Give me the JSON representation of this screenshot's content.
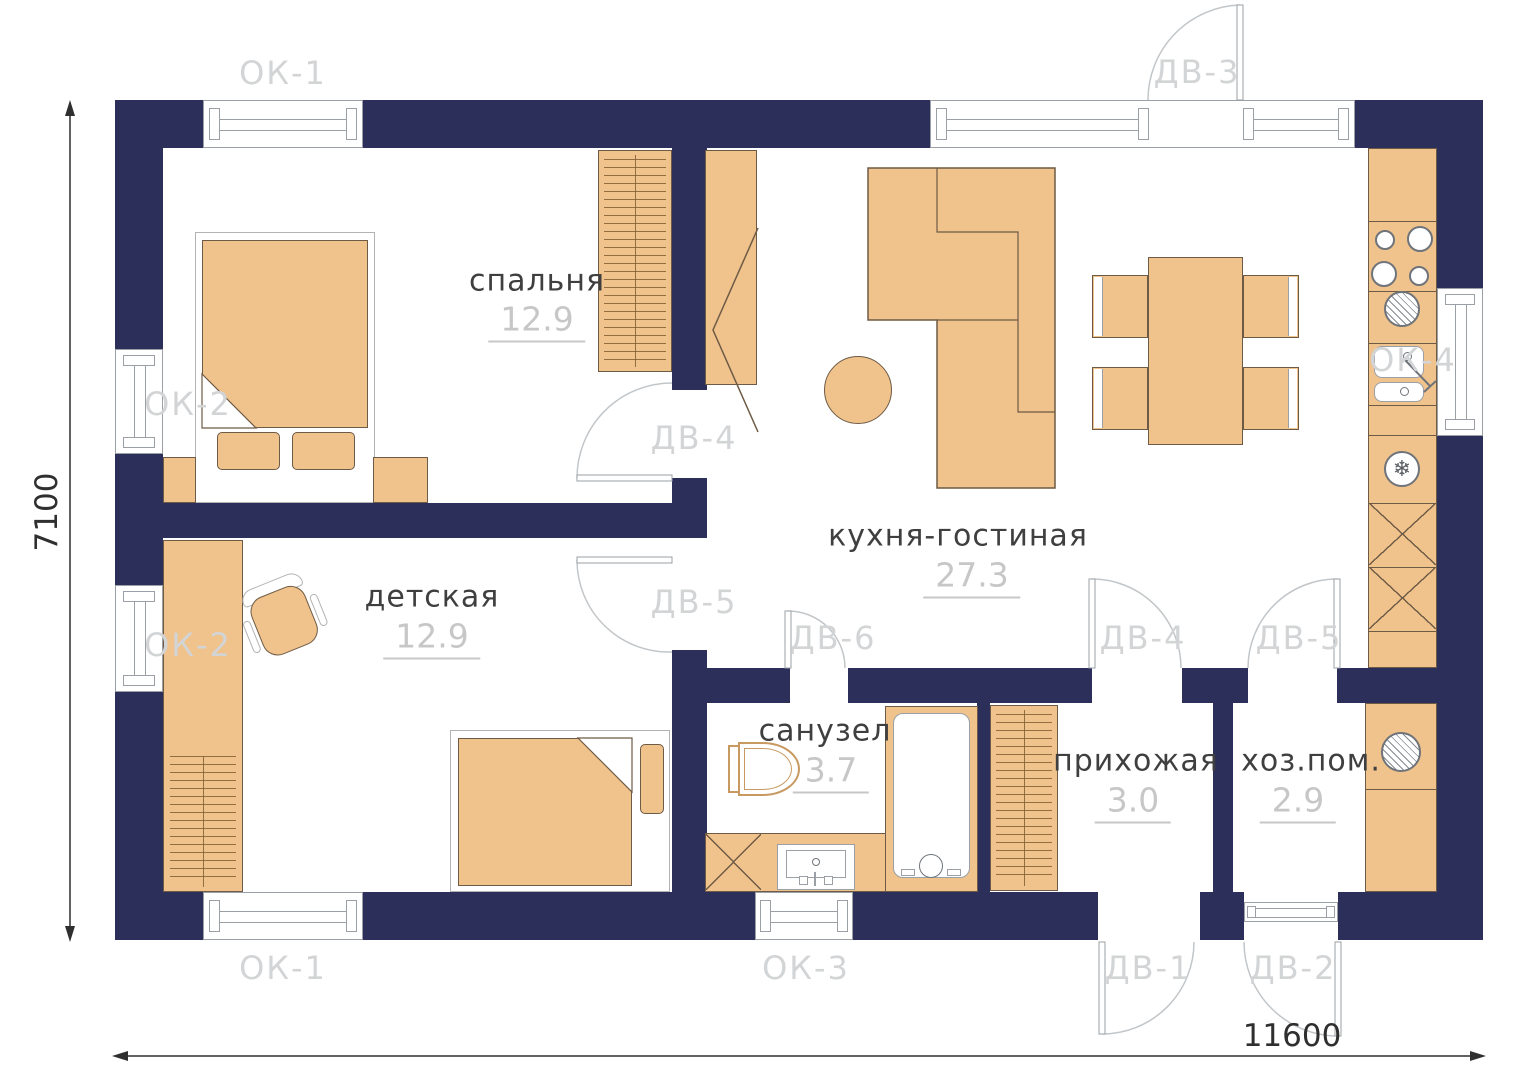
{
  "plan": {
    "rooms": [
      {
        "key": "bedroom",
        "name": "спальня",
        "area": "12.9"
      },
      {
        "key": "nursery",
        "name": "детская",
        "area": "12.9"
      },
      {
        "key": "kitchen_living",
        "name": "кухня-гостиная",
        "area": "27.3"
      },
      {
        "key": "bathroom",
        "name": "санузел",
        "area": "3.7"
      },
      {
        "key": "hallway",
        "name": "прихожая",
        "area": "3.0"
      },
      {
        "key": "utility",
        "name": "хоз.пом.",
        "area": "2.9"
      }
    ],
    "openings": {
      "ok1_top": "ОК-1",
      "ok2_bedroom": "ОК-2",
      "ok2_nursery": "ОК-2",
      "ok1_bottom": "ОК-1",
      "ok3_bottom": "ОК-3",
      "ok4_right": "ОК-4",
      "dv3_entry": "ДВ-3",
      "dv4_bedroom": "ДВ-4",
      "dv5_nursery": "ДВ-5",
      "dv6_bathroom": "ДВ-6",
      "dv4_hallway": "ДВ-4",
      "dv5_utility": "ДВ-5",
      "dv1_exterior": "ДВ-1",
      "dv2_exterior": "ДВ-2"
    },
    "dimensions": {
      "width": "11600",
      "height": "7100"
    },
    "icons": {
      "fridge_snowflake": "❄"
    },
    "colors": {
      "wall": "#2c2f5a",
      "furniture": "#f0c28c",
      "furniture_outline": "#6e5b45",
      "opening_label": "#d2d4d6",
      "room_name": "#3f3f3f",
      "area_number": "#c7c7c7"
    }
  }
}
